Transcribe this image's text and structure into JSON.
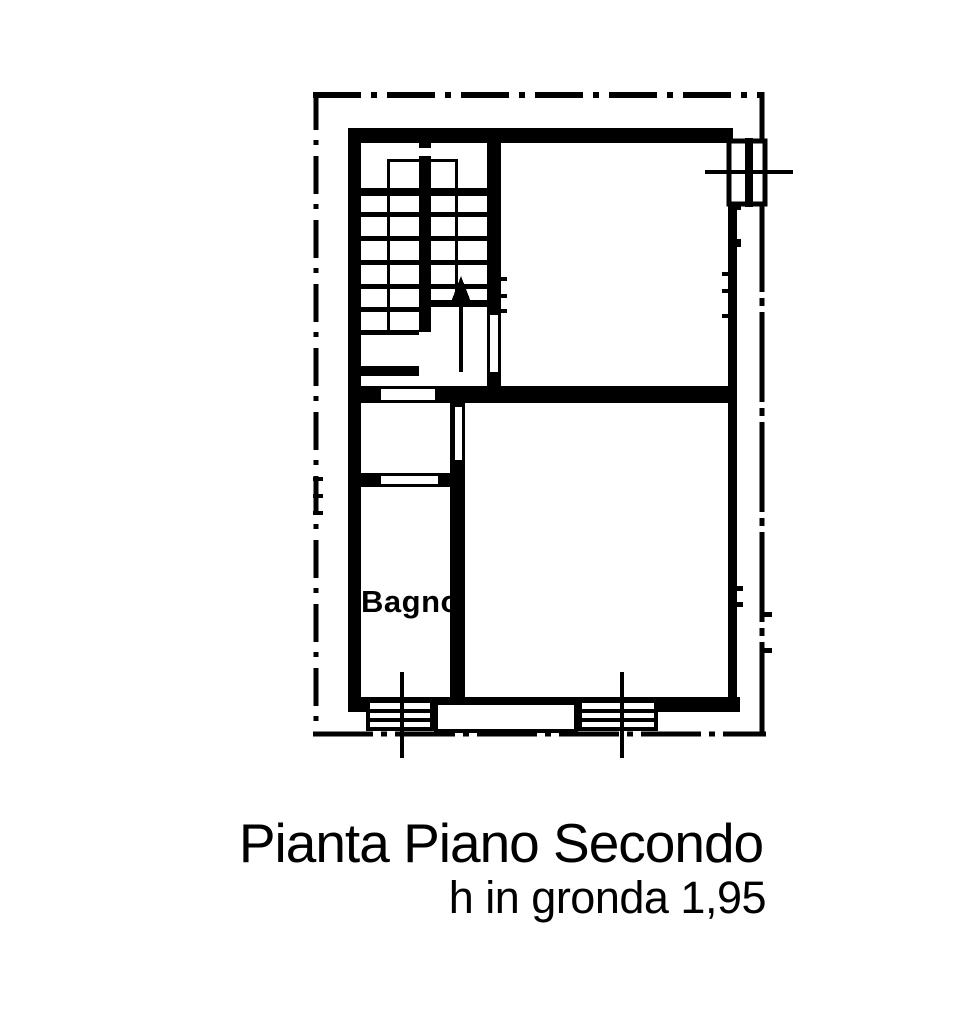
{
  "diagram": {
    "type": "architectural-floor-plan",
    "background_color": "#ffffff",
    "ink_color": "#000000",
    "labels": {
      "room_bathroom": "Bagno",
      "title": "Pianta Piano Secondo",
      "subtitle": "h in gronda 1,95"
    }
  }
}
